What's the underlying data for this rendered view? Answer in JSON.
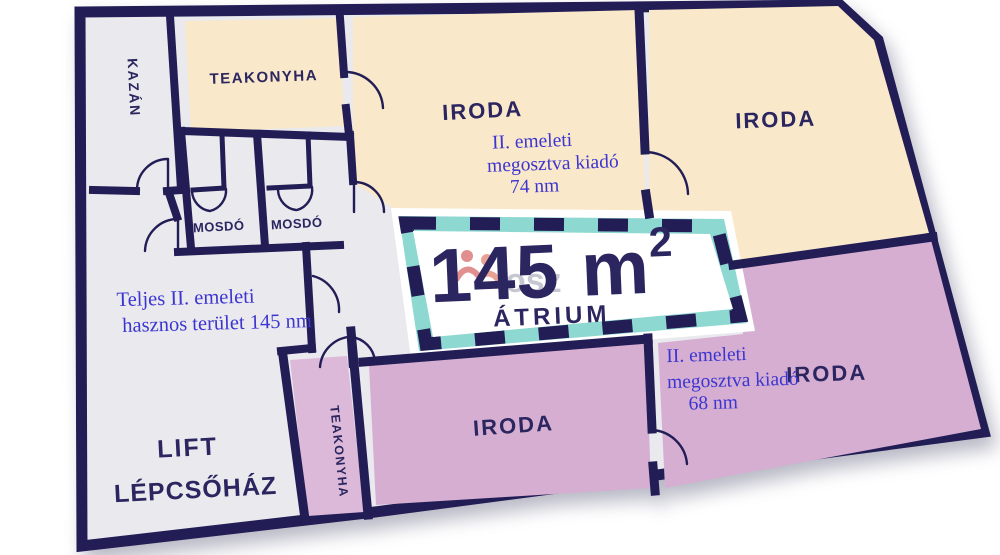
{
  "title": "II. emeleti alaprajz",
  "colors": {
    "navy": "#221d55",
    "textNavy": "#2b2560",
    "beige": "#f9e8ca",
    "purple": "#d5aed2",
    "purpleStrip": "#dcb9d8",
    "gray": "#e9e9ee",
    "teal": "#8ed8d2",
    "white": "#ffffff",
    "blueText": "#3c35cf",
    "watermarkRed": "#cc3434"
  },
  "rooms": {
    "kazan": {
      "label": "KAZÁN"
    },
    "teakonyha_top": {
      "label": "TEAKONYHA"
    },
    "mosdo_1": {
      "label": "MOSDÓ"
    },
    "mosdo_2": {
      "label": "MOSDÓ"
    },
    "iroda_top_middle": {
      "label": "IRODA"
    },
    "iroda_top_right": {
      "label": "IRODA"
    },
    "iroda_bottom": {
      "label": "IRODA"
    },
    "iroda_right": {
      "label": "IRODA"
    },
    "teakonyha_strip": {
      "label": "TEAKONYHA"
    },
    "lift": {
      "label_line1": "LIFT",
      "label_line2": "LÉPCSŐHÁZ"
    },
    "atrium": {
      "area_value": "145 m",
      "area_superscript": "2",
      "label": "ÁTRIUM"
    }
  },
  "annotations": {
    "top_unit": {
      "line1": "II. emeleti",
      "line2": "megosztva kiadó",
      "line3": "74 nm"
    },
    "total_area": {
      "line1": "Teljes II. emeleti",
      "line2": "hasznos terület 145 nm"
    },
    "right_unit": {
      "line1": "II. emeleti",
      "line2": "megosztva kiadó",
      "line3": "68 nm"
    }
  },
  "watermark": {
    "text": "osz"
  }
}
